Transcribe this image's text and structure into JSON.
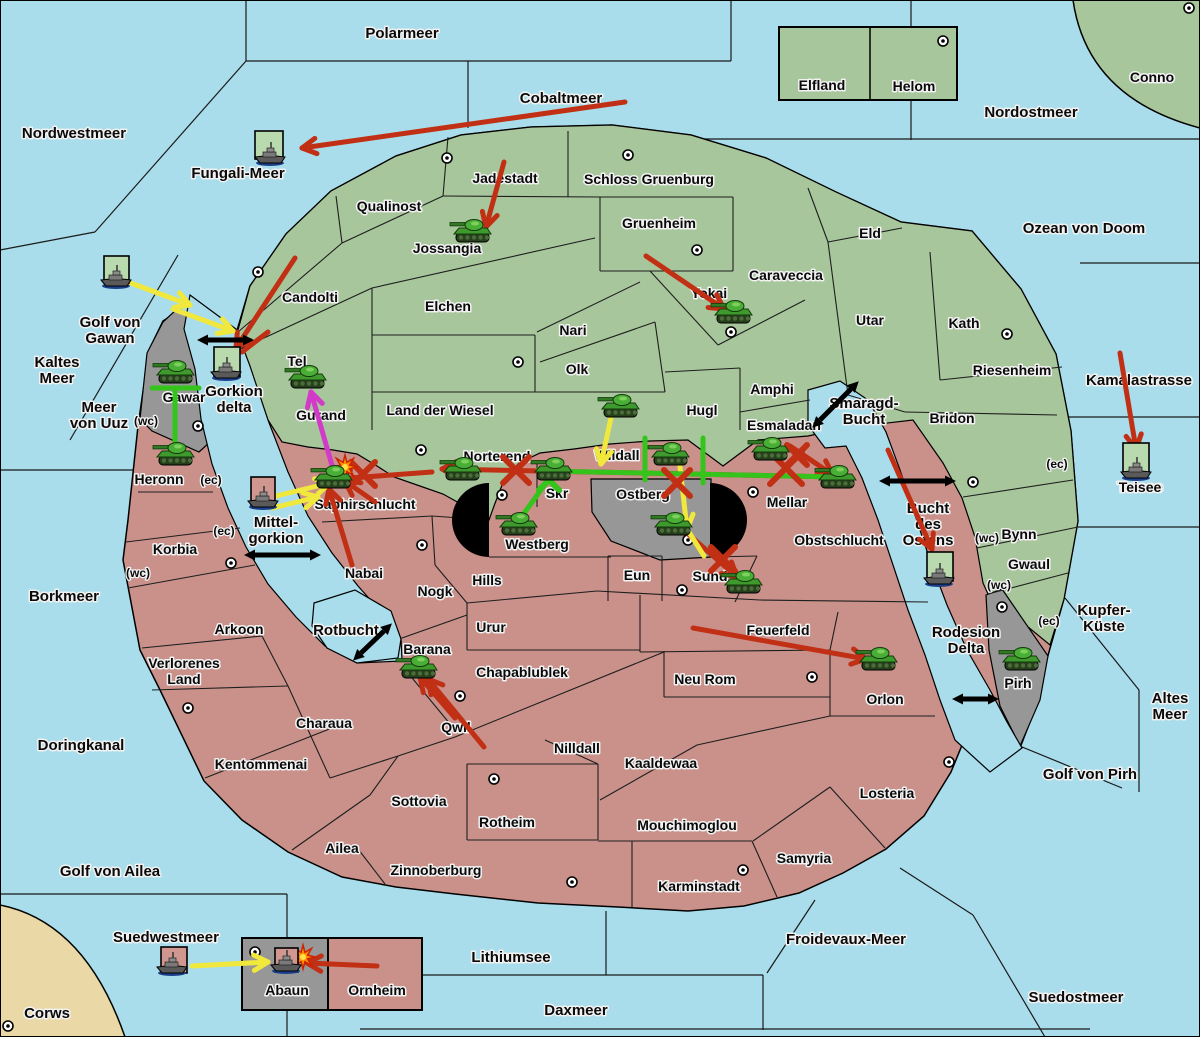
{
  "map_title": "Kriegskarte",
  "colors": {
    "sea": "#a9ddeb",
    "land_green": "#a8c69c",
    "land_red": "#c9918a",
    "land_gray": "#979797",
    "beige": "#ead9a6",
    "flag_green": "#b9d9ae",
    "flag_pink": "#cf978f",
    "red": "#c13014",
    "yellow": "#f0e83c",
    "green": "#35c41c",
    "magenta": "#d23ac8",
    "black": "#0a0a0a"
  },
  "sea_labels": [
    {
      "t": "Polarmeer",
      "x": 402,
      "y": 38
    },
    {
      "t": "Nordwestmeer",
      "x": 74,
      "y": 138
    },
    {
      "t": "Cobaltmeer",
      "x": 561,
      "y": 103
    },
    {
      "t": "Fungali-Meer",
      "x": 238,
      "y": 178
    },
    {
      "t": "Nordostmeer",
      "x": 1031,
      "y": 117
    },
    {
      "t": "Ozean von Doom",
      "x": 1084,
      "y": 233
    },
    {
      "lines": [
        "Kaltes",
        "Meer"
      ],
      "x": 57,
      "y": 367
    },
    {
      "lines": [
        "Golf von",
        "Gawan"
      ],
      "x": 110,
      "y": 327
    },
    {
      "lines": [
        "Meer",
        "von Uuz"
      ],
      "x": 99,
      "y": 412
    },
    {
      "lines": [
        "Gorkion",
        "delta"
      ],
      "x": 234,
      "y": 396
    },
    {
      "t": "Borkmeer",
      "x": 64,
      "y": 601
    },
    {
      "t": "Doringkanal",
      "x": 81,
      "y": 750
    },
    {
      "t": "Golf von Ailea",
      "x": 110,
      "y": 876
    },
    {
      "t": "Suedwestmeer",
      "x": 166,
      "y": 942
    },
    {
      "t": "Corws",
      "x": 47,
      "y": 1018
    },
    {
      "lines": [
        "Smaragd-",
        "Bucht"
      ],
      "x": 864,
      "y": 408
    },
    {
      "lines": [
        "Mittel-",
        "gorkion"
      ],
      "x": 276,
      "y": 527
    },
    {
      "t": "Rotbucht",
      "x": 346,
      "y": 635
    },
    {
      "lines": [
        "Bucht",
        "des",
        "Ostens"
      ],
      "x": 928,
      "y": 513
    },
    {
      "t": "Kamalastrasse",
      "x": 1139,
      "y": 385
    },
    {
      "t": "Teisee",
      "x": 1140,
      "y": 492
    },
    {
      "lines": [
        "Kupfer-",
        "Küste"
      ],
      "x": 1104,
      "y": 615
    },
    {
      "lines": [
        "Altes",
        "Meer"
      ],
      "x": 1170,
      "y": 703
    },
    {
      "t": "Golf von Pirh",
      "x": 1090,
      "y": 779
    },
    {
      "lines": [
        "Rodesion",
        "Delta"
      ],
      "x": 966,
      "y": 637
    },
    {
      "t": "Froidevaux-Meer",
      "x": 846,
      "y": 944
    },
    {
      "t": "Lithiumsee",
      "x": 511,
      "y": 962
    },
    {
      "t": "Daxmeer",
      "x": 576,
      "y": 1015
    },
    {
      "t": "Suedostmeer",
      "x": 1076,
      "y": 1002
    }
  ],
  "land_labels": [
    {
      "t": "Conno",
      "x": 1152,
      "y": 82
    },
    {
      "t": "Elfland",
      "x": 822,
      "y": 90
    },
    {
      "t": "Helom",
      "x": 914,
      "y": 91
    },
    {
      "t": "Qualinost",
      "x": 389,
      "y": 211
    },
    {
      "t": "Jadestadt",
      "x": 505,
      "y": 183
    },
    {
      "t": "Schloss Gruenburg",
      "x": 649,
      "y": 184
    },
    {
      "t": "Jossangia",
      "x": 447,
      "y": 253
    },
    {
      "t": "Gruenheim",
      "x": 659,
      "y": 228
    },
    {
      "t": "Caraveccia",
      "x": 786,
      "y": 280
    },
    {
      "t": "Yokai",
      "x": 709,
      "y": 298
    },
    {
      "t": "Elchen",
      "x": 448,
      "y": 311
    },
    {
      "t": "Nari",
      "x": 573,
      "y": 335
    },
    {
      "t": "Tel",
      "x": 297,
      "y": 366
    },
    {
      "t": "Olk",
      "x": 577,
      "y": 374
    },
    {
      "t": "Eld",
      "x": 870,
      "y": 238
    },
    {
      "t": "Utar",
      "x": 870,
      "y": 325
    },
    {
      "t": "Kath",
      "x": 964,
      "y": 328
    },
    {
      "t": "Riesenheim",
      "x": 1012,
      "y": 375
    },
    {
      "t": "Bridon",
      "x": 952,
      "y": 423
    },
    {
      "t": "Amphi",
      "x": 772,
      "y": 394
    },
    {
      "t": "Hugl",
      "x": 702,
      "y": 415
    },
    {
      "t": "Land der Wiesel",
      "x": 440,
      "y": 415
    },
    {
      "t": "Esmaladan",
      "x": 784,
      "y": 430
    },
    {
      "t": "Candolti",
      "x": 310,
      "y": 302
    },
    {
      "t": "Gurand",
      "x": 321,
      "y": 420
    },
    {
      "t": "Gawar",
      "x": 184,
      "y": 402
    },
    {
      "t": "Bynn",
      "x": 1019,
      "y": 539
    },
    {
      "t": "Gwaul",
      "x": 1029,
      "y": 569
    },
    {
      "t": "Norterend",
      "x": 497,
      "y": 461
    },
    {
      "t": "Wildall",
      "x": 617,
      "y": 460
    },
    {
      "t": "Saphirschlucht",
      "x": 365,
      "y": 509
    },
    {
      "t": "Skr",
      "x": 557,
      "y": 498
    },
    {
      "t": "Ostberg",
      "x": 643,
      "y": 499
    },
    {
      "t": "Mellar",
      "x": 787,
      "y": 507
    },
    {
      "t": "Westberg",
      "x": 537,
      "y": 549
    },
    {
      "t": "Obstschlucht",
      "x": 839,
      "y": 545
    },
    {
      "t": "Eun",
      "x": 637,
      "y": 580
    },
    {
      "t": "Sund",
      "x": 710,
      "y": 581
    },
    {
      "t": "Hills",
      "x": 487,
      "y": 585
    },
    {
      "t": "Nabai",
      "x": 364,
      "y": 578
    },
    {
      "t": "Nogk",
      "x": 435,
      "y": 596
    },
    {
      "t": "Heronn",
      "x": 159,
      "y": 484
    },
    {
      "t": "Korbia",
      "x": 175,
      "y": 554
    },
    {
      "t": "Arkoon",
      "x": 239,
      "y": 634
    },
    {
      "lines": [
        "Verlorenes",
        "Land"
      ],
      "x": 184,
      "y": 668
    },
    {
      "t": "Barana",
      "x": 427,
      "y": 654
    },
    {
      "t": "Urur",
      "x": 491,
      "y": 632
    },
    {
      "t": "Chapablublek",
      "x": 522,
      "y": 677
    },
    {
      "t": "Feuerfeld",
      "x": 778,
      "y": 635
    },
    {
      "t": "Neu Rom",
      "x": 705,
      "y": 684
    },
    {
      "t": "Orlon",
      "x": 885,
      "y": 704
    },
    {
      "t": "Qwil",
      "x": 456,
      "y": 732
    },
    {
      "t": "Charaua",
      "x": 324,
      "y": 728
    },
    {
      "t": "Kentommenai",
      "x": 261,
      "y": 769
    },
    {
      "t": "Nilldall",
      "x": 577,
      "y": 753
    },
    {
      "t": "Kaaldewaa",
      "x": 661,
      "y": 768
    },
    {
      "t": "Sottovia",
      "x": 419,
      "y": 806
    },
    {
      "t": "Rotheim",
      "x": 507,
      "y": 827
    },
    {
      "t": "Mouchimoglou",
      "x": 687,
      "y": 830
    },
    {
      "t": "Losteria",
      "x": 887,
      "y": 798
    },
    {
      "t": "Samyria",
      "x": 804,
      "y": 863
    },
    {
      "t": "Ailea",
      "x": 342,
      "y": 853
    },
    {
      "t": "Zinnoberburg",
      "x": 436,
      "y": 875
    },
    {
      "t": "Karminstadt",
      "x": 699,
      "y": 891
    },
    {
      "t": "Abaun",
      "x": 287,
      "y": 995
    },
    {
      "t": "Ornheim",
      "x": 377,
      "y": 995
    },
    {
      "t": "Pirh",
      "x": 1018,
      "y": 688
    },
    {
      "t": "Teisee",
      "x": 1140,
      "y": 492
    }
  ],
  "small_labels": [
    {
      "t": "(wc)",
      "x": 146,
      "y": 425
    },
    {
      "t": "(ec)",
      "x": 211,
      "y": 484
    },
    {
      "t": "(ec)",
      "x": 224,
      "y": 535
    },
    {
      "t": "(wc)",
      "x": 138,
      "y": 577
    },
    {
      "t": "(ec)",
      "x": 1057,
      "y": 468
    },
    {
      "t": "(wc)",
      "x": 987,
      "y": 542
    },
    {
      "t": "(wc)",
      "x": 999,
      "y": 589
    },
    {
      "t": "(ec)",
      "x": 1049,
      "y": 625
    }
  ],
  "city_dots": [
    [
      447,
      158
    ],
    [
      628,
      155
    ],
    [
      697,
      250
    ],
    [
      731,
      332
    ],
    [
      258,
      272
    ],
    [
      943,
      41
    ],
    [
      1189,
      8
    ],
    [
      1007,
      334
    ],
    [
      518,
      362
    ],
    [
      421,
      450
    ],
    [
      502,
      495
    ],
    [
      422,
      545
    ],
    [
      688,
      540
    ],
    [
      682,
      590
    ],
    [
      753,
      492
    ],
    [
      231,
      563
    ],
    [
      188,
      708
    ],
    [
      460,
      696
    ],
    [
      812,
      677
    ],
    [
      494,
      779
    ],
    [
      572,
      882
    ],
    [
      949,
      762
    ],
    [
      743,
      870
    ],
    [
      8,
      1026
    ],
    [
      255,
      952
    ],
    [
      973,
      482
    ],
    [
      1002,
      607
    ],
    [
      198,
      426
    ]
  ],
  "units": [
    {
      "k": "tank",
      "x": 472,
      "y": 232
    },
    {
      "k": "tank",
      "x": 733,
      "y": 313
    },
    {
      "k": "tank",
      "x": 307,
      "y": 378
    },
    {
      "k": "tank",
      "x": 175,
      "y": 373
    },
    {
      "k": "tank",
      "x": 175,
      "y": 455
    },
    {
      "k": "tank",
      "x": 333,
      "y": 478
    },
    {
      "k": "tank",
      "x": 462,
      "y": 470
    },
    {
      "k": "tank",
      "x": 553,
      "y": 470
    },
    {
      "k": "tank",
      "x": 518,
      "y": 525
    },
    {
      "k": "tank",
      "x": 620,
      "y": 407
    },
    {
      "k": "tank",
      "x": 670,
      "y": 455
    },
    {
      "k": "tank",
      "x": 770,
      "y": 450
    },
    {
      "k": "tank",
      "x": 837,
      "y": 478
    },
    {
      "k": "tank",
      "x": 673,
      "y": 525
    },
    {
      "k": "tank",
      "x": 743,
      "y": 583
    },
    {
      "k": "tank",
      "x": 418,
      "y": 668
    },
    {
      "k": "tank",
      "x": 878,
      "y": 660
    },
    {
      "k": "tank",
      "x": 1021,
      "y": 660
    },
    {
      "k": "ship",
      "x": 270,
      "y": 155,
      "bx": 255,
      "by": 131,
      "bw": 28,
      "bh": 28,
      "bc": "g"
    },
    {
      "k": "ship",
      "x": 116,
      "y": 278,
      "bx": 104,
      "by": 256,
      "bw": 25,
      "bh": 27,
      "bc": "g"
    },
    {
      "k": "ship",
      "x": 226,
      "y": 370,
      "bx": 214,
      "by": 347,
      "bw": 26,
      "bh": 30,
      "bc": "g"
    },
    {
      "k": "ship",
      "x": 263,
      "y": 499,
      "bx": 251,
      "by": 477,
      "bw": 24,
      "bh": 29,
      "bc": "p"
    },
    {
      "k": "ship",
      "x": 939,
      "y": 576,
      "bx": 927,
      "by": 552,
      "bw": 26,
      "bh": 29,
      "bc": "g"
    },
    {
      "k": "ship",
      "x": 1136,
      "y": 470,
      "bx": 1123,
      "by": 443,
      "bw": 26,
      "bh": 31,
      "bc": "g"
    },
    {
      "k": "ship",
      "x": 172,
      "y": 965,
      "bx": 161,
      "by": 947,
      "bw": 26,
      "bh": 26,
      "bc": "p"
    },
    {
      "k": "ship",
      "x": 286,
      "y": 963,
      "bx": 275,
      "by": 948,
      "bw": 23,
      "bh": 24,
      "bc": "p"
    }
  ],
  "arrows": [
    {
      "x1": 625,
      "y1": 102,
      "x2": 302,
      "y2": 148,
      "c": "red",
      "h": true
    },
    {
      "x1": 504,
      "y1": 162,
      "x2": 486,
      "y2": 227,
      "c": "red",
      "h": true
    },
    {
      "x1": 646,
      "y1": 256,
      "x2": 724,
      "y2": 309,
      "c": "red",
      "h": true
    },
    {
      "x1": 295,
      "y1": 258,
      "x2": 236,
      "y2": 348,
      "c": "red",
      "h": true
    },
    {
      "x1": 268,
      "y1": 332,
      "x2": 242,
      "y2": 352,
      "c": "red",
      "h": false
    },
    {
      "x1": 352,
      "y1": 565,
      "x2": 329,
      "y2": 489,
      "c": "red",
      "h": true
    },
    {
      "x1": 375,
      "y1": 502,
      "x2": 345,
      "y2": 481,
      "c": "red",
      "h": true
    },
    {
      "x1": 432,
      "y1": 472,
      "x2": 337,
      "y2": 479,
      "c": "red",
      "h": true
    },
    {
      "x1": 838,
      "y1": 477,
      "x2": 442,
      "y2": 469,
      "c": "red",
      "h": true
    },
    {
      "x1": 790,
      "y1": 446,
      "x2": 833,
      "y2": 475,
      "c": "red",
      "h": true
    },
    {
      "x1": 687,
      "y1": 533,
      "x2": 737,
      "y2": 577,
      "c": "red",
      "h": true
    },
    {
      "x1": 693,
      "y1": 628,
      "x2": 866,
      "y2": 659,
      "c": "red",
      "h": true
    },
    {
      "x1": 484,
      "y1": 747,
      "x2": 428,
      "y2": 679,
      "c": "red",
      "h": true
    },
    {
      "x1": 455,
      "y1": 718,
      "x2": 420,
      "y2": 677,
      "c": "red",
      "h": true
    },
    {
      "x1": 1120,
      "y1": 353,
      "x2": 1136,
      "y2": 449,
      "c": "red",
      "h": true
    },
    {
      "x1": 888,
      "y1": 450,
      "x2": 932,
      "y2": 549,
      "c": "red",
      "h": true
    },
    {
      "x1": 377,
      "y1": 966,
      "x2": 307,
      "y2": 963,
      "c": "red",
      "h": true
    },
    {
      "x1": 128,
      "y1": 282,
      "x2": 190,
      "y2": 305,
      "c": "yellow",
      "h": true
    },
    {
      "x1": 173,
      "y1": 309,
      "x2": 233,
      "y2": 331,
      "c": "yellow",
      "h": true
    },
    {
      "x1": 276,
      "y1": 496,
      "x2": 330,
      "y2": 483,
      "c": "yellow",
      "h": true
    },
    {
      "x1": 272,
      "y1": 508,
      "x2": 318,
      "y2": 497,
      "c": "yellow",
      "h": true
    },
    {
      "x1": 612,
      "y1": 413,
      "x2": 601,
      "y2": 464,
      "c": "yellow",
      "h": true
    },
    {
      "x1": 678,
      "y1": 449,
      "x2": 687,
      "y2": 529,
      "c": "yellow",
      "h": true
    },
    {
      "x1": 687,
      "y1": 529,
      "x2": 704,
      "y2": 556,
      "c": "yellow",
      "h": false
    },
    {
      "x1": 192,
      "y1": 966,
      "x2": 268,
      "y2": 962,
      "c": "yellow",
      "h": true
    },
    {
      "x1": 175,
      "y1": 388,
      "x2": 175,
      "y2": 452,
      "c": "green",
      "h": false
    },
    {
      "x1": 152,
      "y1": 388,
      "x2": 199,
      "y2": 388,
      "c": "green",
      "h": false
    },
    {
      "x1": 520,
      "y1": 519,
      "x2": 553,
      "y2": 473,
      "c": "green",
      "h": false
    },
    {
      "x1": 545,
      "y1": 471,
      "x2": 836,
      "y2": 477,
      "c": "green",
      "h": false
    },
    {
      "x1": 645,
      "y1": 438,
      "x2": 645,
      "y2": 480,
      "c": "green",
      "h": false
    },
    {
      "x1": 703,
      "y1": 438,
      "x2": 703,
      "y2": 483,
      "c": "green",
      "h": false
    },
    {
      "x1": 333,
      "y1": 469,
      "x2": 311,
      "y2": 392,
      "c": "magenta",
      "h": true
    }
  ],
  "double_arrows": [
    {
      "x1": 208,
      "y1": 340,
      "x2": 243,
      "y2": 340
    },
    {
      "x1": 820,
      "y1": 420,
      "x2": 851,
      "y2": 389
    },
    {
      "x1": 255,
      "y1": 555,
      "x2": 310,
      "y2": 555
    },
    {
      "x1": 361,
      "y1": 653,
      "x2": 384,
      "y2": 631
    },
    {
      "x1": 890,
      "y1": 481,
      "x2": 945,
      "y2": 481
    },
    {
      "x1": 963,
      "y1": 699,
      "x2": 988,
      "y2": 699
    }
  ],
  "x_marks": [
    {
      "x": 363,
      "y": 474,
      "c": "red",
      "s": 12
    },
    {
      "x": 516,
      "y": 470,
      "c": "red",
      "s": 13
    },
    {
      "x": 677,
      "y": 483,
      "c": "red",
      "s": 13
    },
    {
      "x": 723,
      "y": 559,
      "c": "red",
      "s": 12
    },
    {
      "x": 786,
      "y": 468,
      "c": "red",
      "s": 16
    },
    {
      "x": 797,
      "y": 455,
      "c": "red",
      "s": 10
    },
    {
      "x": 549,
      "y": 480,
      "c": "green",
      "s": 10
    }
  ],
  "explosions": [
    {
      "x": 345,
      "y": 467
    },
    {
      "x": 303,
      "y": 957
    }
  ],
  "pies": [
    {
      "cx": 489,
      "cy": 520,
      "r": 37,
      "side": "left"
    },
    {
      "cx": 710,
      "cy": 520,
      "r": 37,
      "side": "right"
    }
  ]
}
